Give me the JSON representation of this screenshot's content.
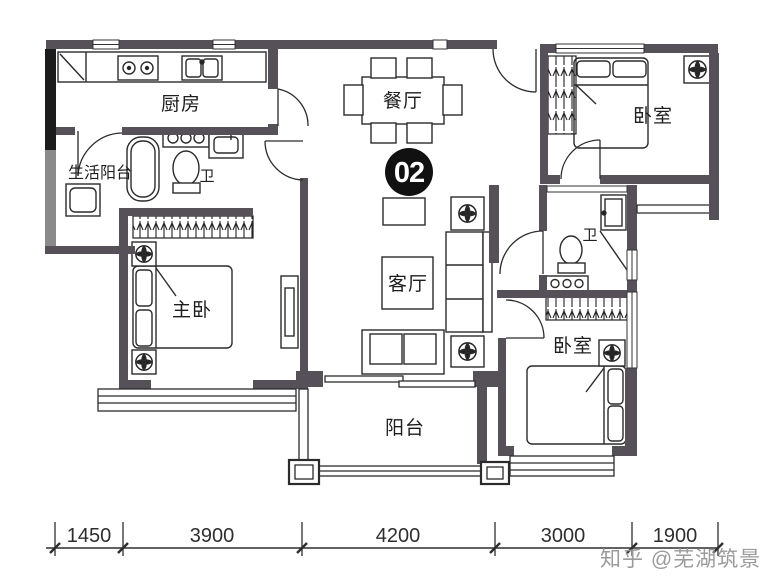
{
  "unit_badge": "02",
  "rooms": {
    "kitchen": "厨房",
    "dining": "餐厅",
    "bedroom_top_right": "卧室",
    "bedroom_bottom_right": "卧室",
    "master_bedroom": "主卧",
    "living_room": "客厅",
    "balcony": "阳台",
    "service_balcony": "生活阳台",
    "bathroom_left": "卫",
    "bathroom_right": "卫"
  },
  "dimensions": {
    "values": [
      "1450",
      "3900",
      "4200",
      "3000",
      "1900"
    ]
  },
  "watermark": "知乎 @芜湖筑景",
  "colors": {
    "wall": "#565059",
    "wall_dark": "#1c1c1c",
    "wall_gray": "#8a8a8a",
    "line": "#2b2b2b",
    "badge": "#111111",
    "watermark_gray": "#9b9b9b",
    "background": "#ffffff"
  }
}
